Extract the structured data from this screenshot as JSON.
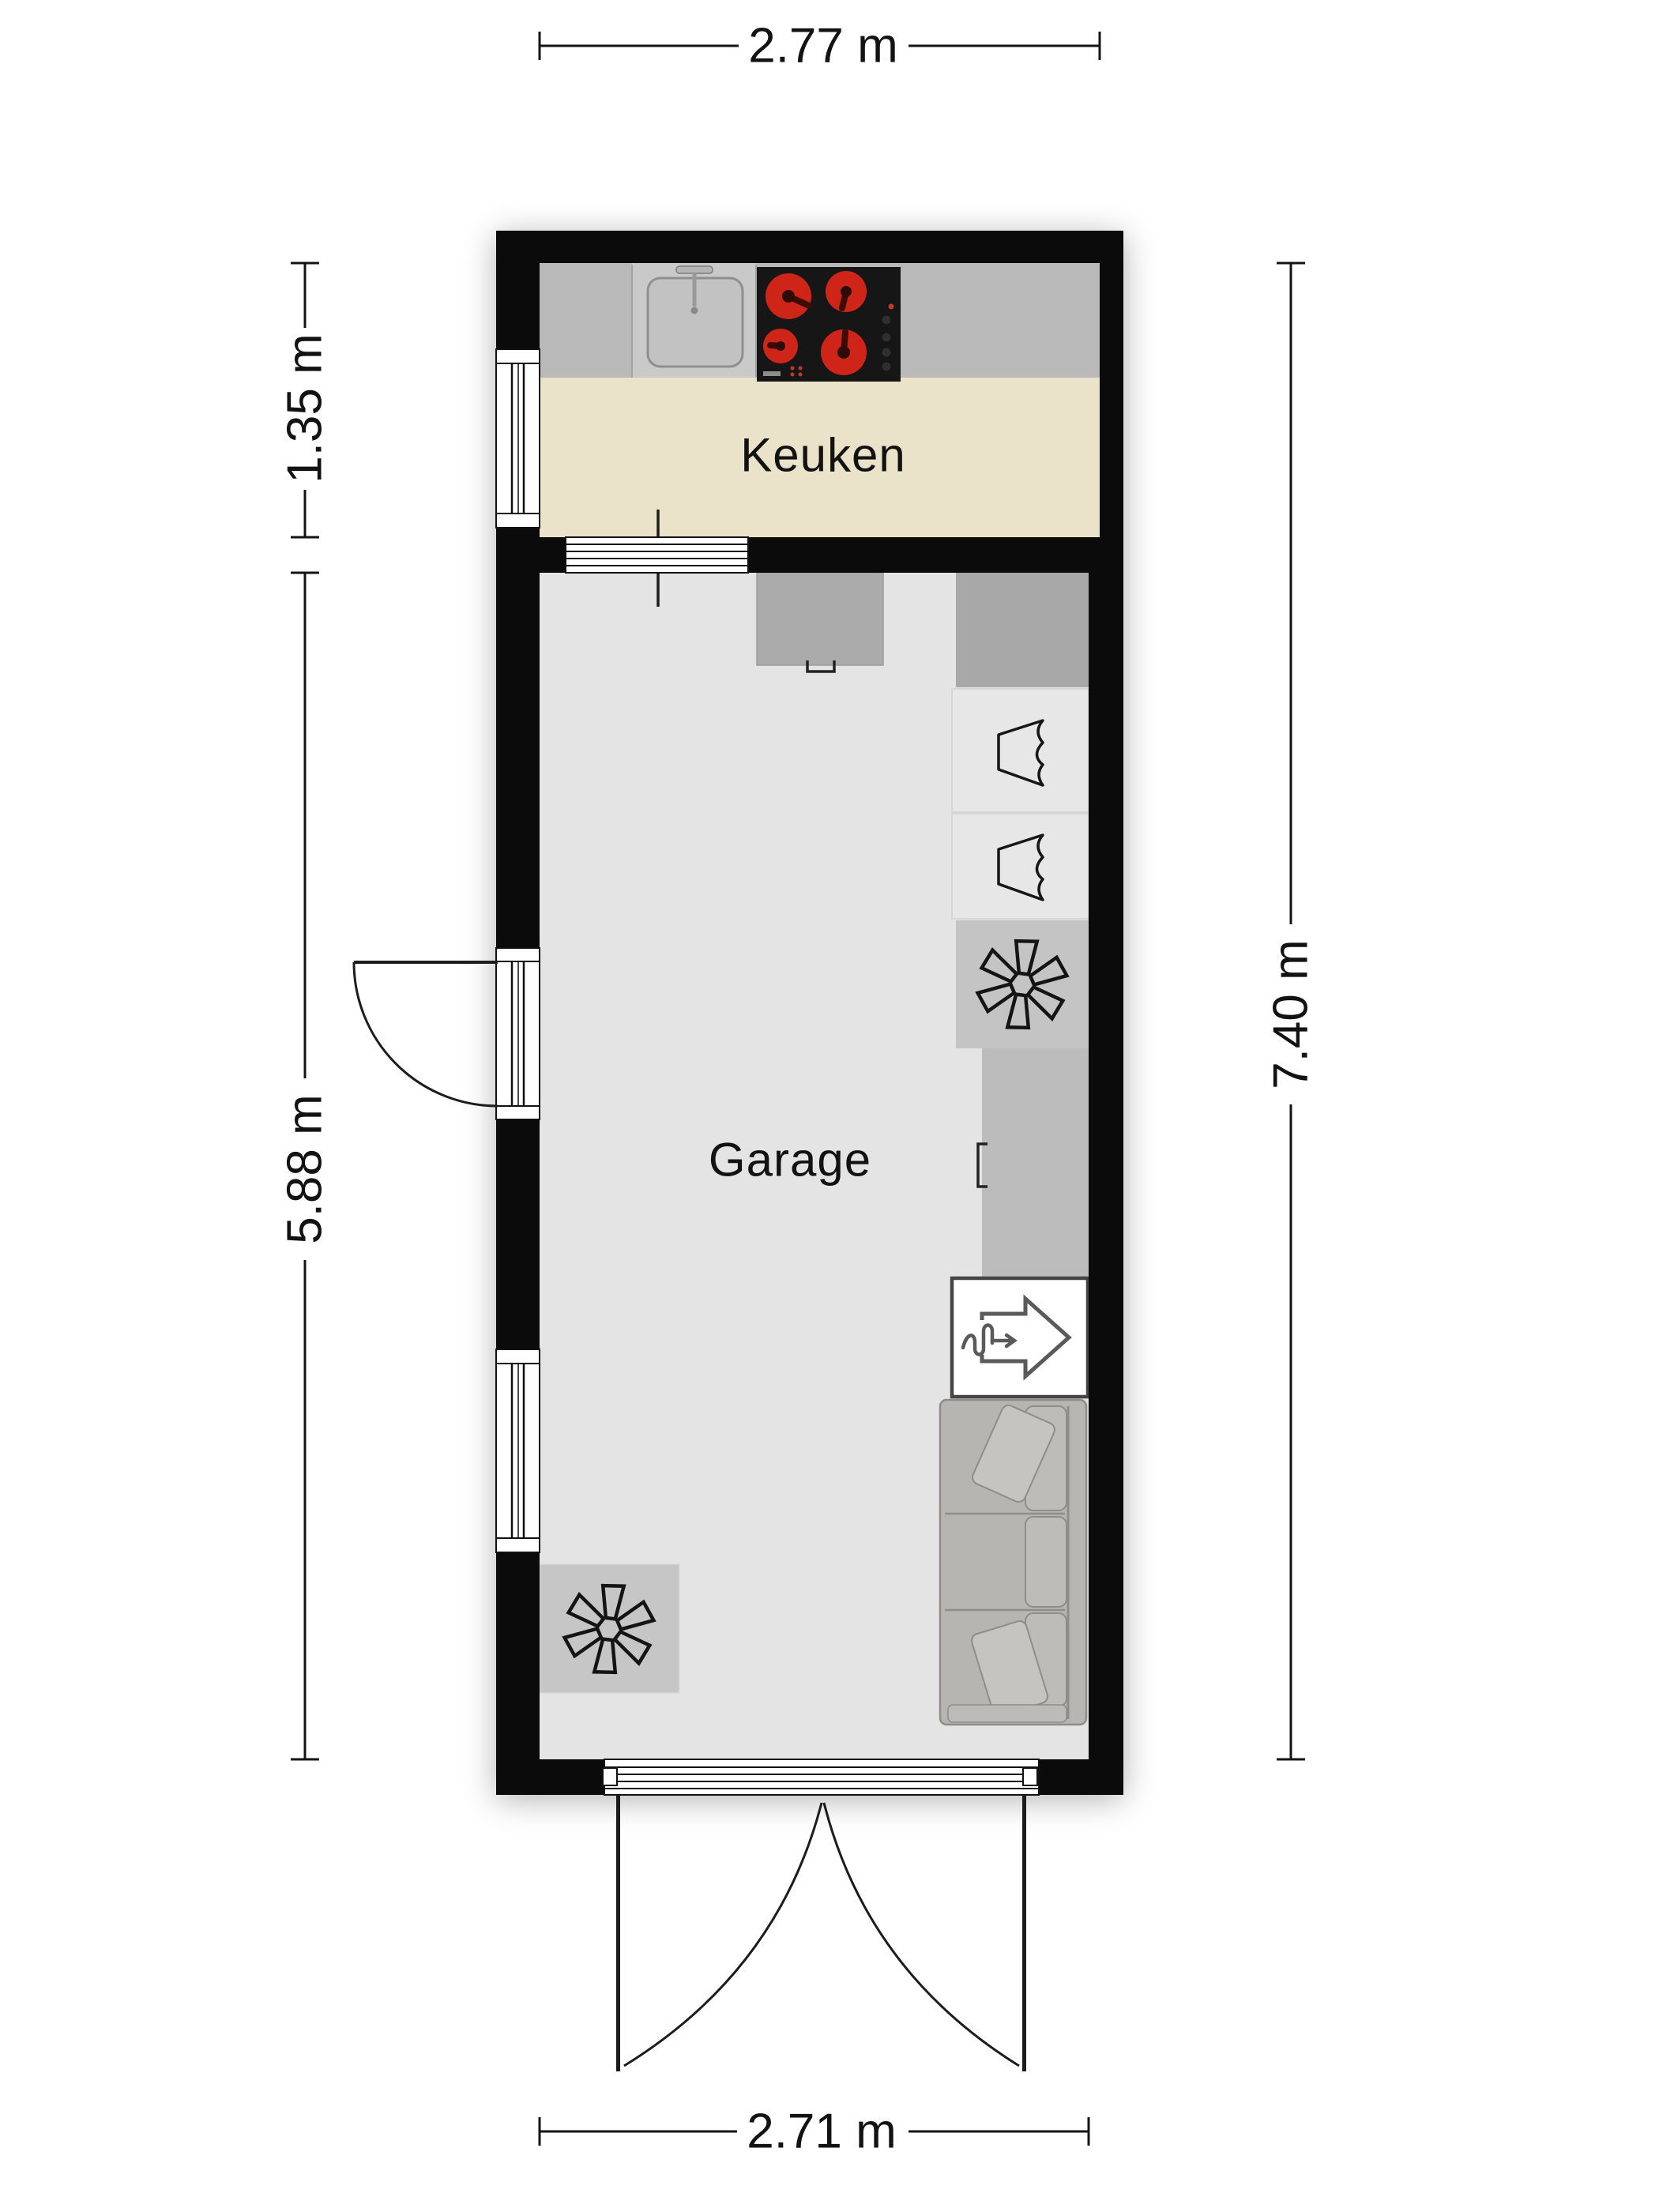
{
  "labels": {
    "kitchen": "Keuken",
    "garage": "Garage"
  },
  "dimensions": {
    "top_width": "2.77 m",
    "kitchen_height": "1.35 m",
    "garage_height": "5.88 m",
    "total_height": "7.40 m",
    "bottom_width": "2.71 m"
  },
  "colors": {
    "wall": "#0b0b0b",
    "kitchen_floor": "#eae2c9",
    "garage_floor": "#e4e4e4",
    "counter": "#b9b9b9",
    "sink_unit": "#c9c9c9",
    "cooktop": "#161616",
    "burner": "#cf2519",
    "counter_right_dark": "#a8a8a8",
    "wardrobe": "#e7e7e7",
    "fan_block": "#c4c4c4",
    "sofa": "#b7b5b2",
    "line": "#141414",
    "white": "#ffffff"
  },
  "icons": [
    "fan-icon",
    "wardrobe-icon",
    "heat-recovery-arrow-icon",
    "sink-icon",
    "cooktop-icon",
    "door-swing-arc-icon"
  ]
}
